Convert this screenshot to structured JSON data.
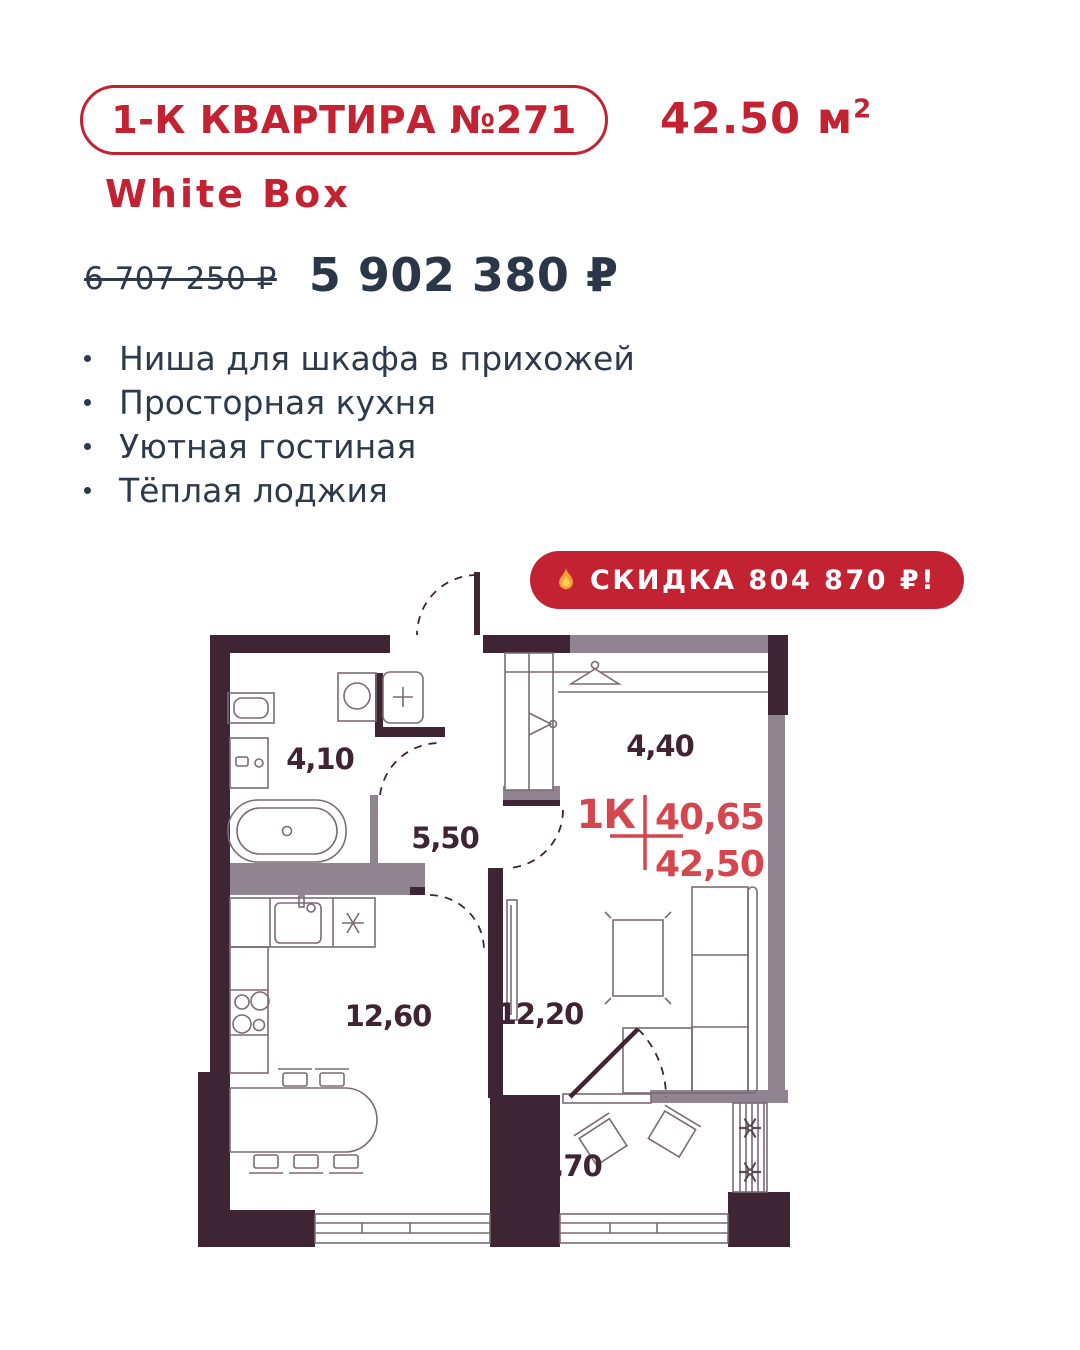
{
  "header": {
    "unit_badge": "1-К КВАРТИРА №271",
    "area_value": "42.50 м",
    "area_superscript": "2",
    "finish": "White Box"
  },
  "pricing": {
    "old_price": "6 707 250 ₽",
    "new_price": "5 902 380 ₽"
  },
  "features": [
    "Ниша для шкафа в прихожей",
    "Просторная кухня",
    "Уютная гостиная",
    "Тёплая лоджия"
  ],
  "discount": {
    "icon": "fire-icon",
    "text": "СКИДКА 804 870 ₽!"
  },
  "floor_plan": {
    "type_label": "1К",
    "area_living": "40,65",
    "area_total": "42,50",
    "rooms": [
      {
        "name": "bathroom",
        "area": "4,10"
      },
      {
        "name": "hallway",
        "area": "5,50"
      },
      {
        "name": "wardrobe",
        "area": "4,40"
      },
      {
        "name": "kitchen",
        "area": "12,60"
      },
      {
        "name": "living-room",
        "area": "12,20"
      },
      {
        "name": "loggia",
        "area": "3,70"
      }
    ]
  },
  "colors": {
    "accent_red": "#c22231",
    "plan_red": "#d4474e",
    "wall_dark": "#3f2433",
    "wall_partition": "#8f8490",
    "text_dark": "#2e3a4c"
  }
}
